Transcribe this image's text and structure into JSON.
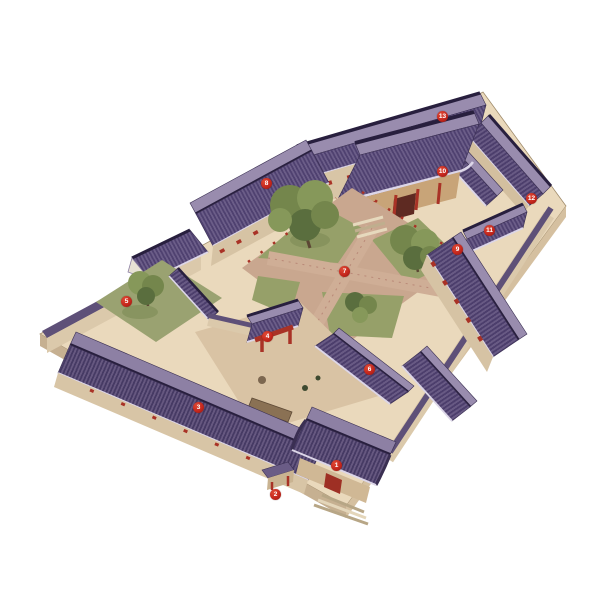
{
  "figure": {
    "description": "Hand-painted bird's-eye axonometric illustration of a traditional Beijing siheyuan courtyard residence with numbered callout badges",
    "background": "#ffffff"
  },
  "palette": {
    "roof_dark": "#4f4170",
    "roof_mid": "#6b5d88",
    "roof_light": "#998cae",
    "ridge": "#281f3e",
    "eave_trim": "#dcd6e8",
    "wall_tan": "#d8c5a6",
    "wall_shadow": "#b5a287",
    "platform": "#ead9bc",
    "path_brick": "#cfae96",
    "lawn_green": "#96a069",
    "tree_green": "#74864c",
    "accent_red": "#a93226",
    "marker_red": "#c5271d"
  },
  "markers": [
    {
      "label": "1",
      "x": 337,
      "y": 466
    },
    {
      "label": "2",
      "x": 276,
      "y": 495
    },
    {
      "label": "3",
      "x": 199,
      "y": 408
    },
    {
      "label": "4",
      "x": 268,
      "y": 337
    },
    {
      "label": "5",
      "x": 127,
      "y": 302
    },
    {
      "label": "6",
      "x": 370,
      "y": 370
    },
    {
      "label": "7",
      "x": 345,
      "y": 272
    },
    {
      "label": "8",
      "x": 267,
      "y": 184
    },
    {
      "label": "9",
      "x": 458,
      "y": 250
    },
    {
      "label": "10",
      "x": 443,
      "y": 172
    },
    {
      "label": "11",
      "x": 490,
      "y": 231
    },
    {
      "label": "12",
      "x": 532,
      "y": 199
    },
    {
      "label": "13",
      "x": 443,
      "y": 117
    }
  ]
}
